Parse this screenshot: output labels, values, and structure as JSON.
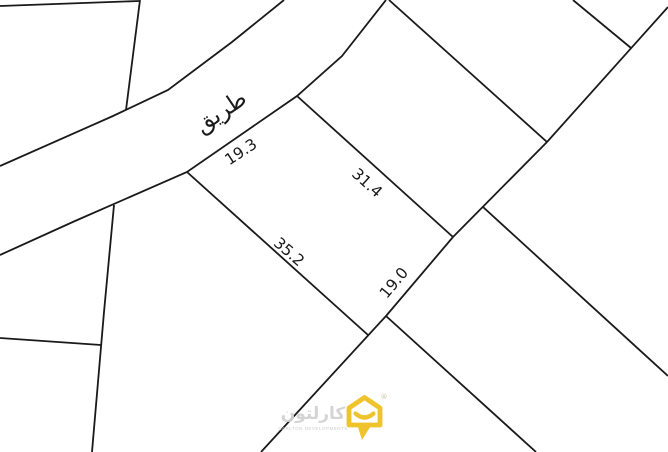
{
  "map": {
    "road_label": "طريق",
    "dimensions": {
      "frontage_nw": "19.3",
      "side_ne": "31.4",
      "side_sw": "35.2",
      "side_se": "19.0"
    }
  },
  "watermark": {
    "brand_arabic": "كارلتون",
    "brand_caption": "CARLTON DEVELOPMENTS",
    "registered": "®"
  },
  "colors": {
    "background": "#ffffff",
    "line": "#1a1a1a",
    "label_text": "#1a1a1a",
    "logo_yellow": "#efc32b",
    "watermark_gray": "#d2d2d2"
  }
}
